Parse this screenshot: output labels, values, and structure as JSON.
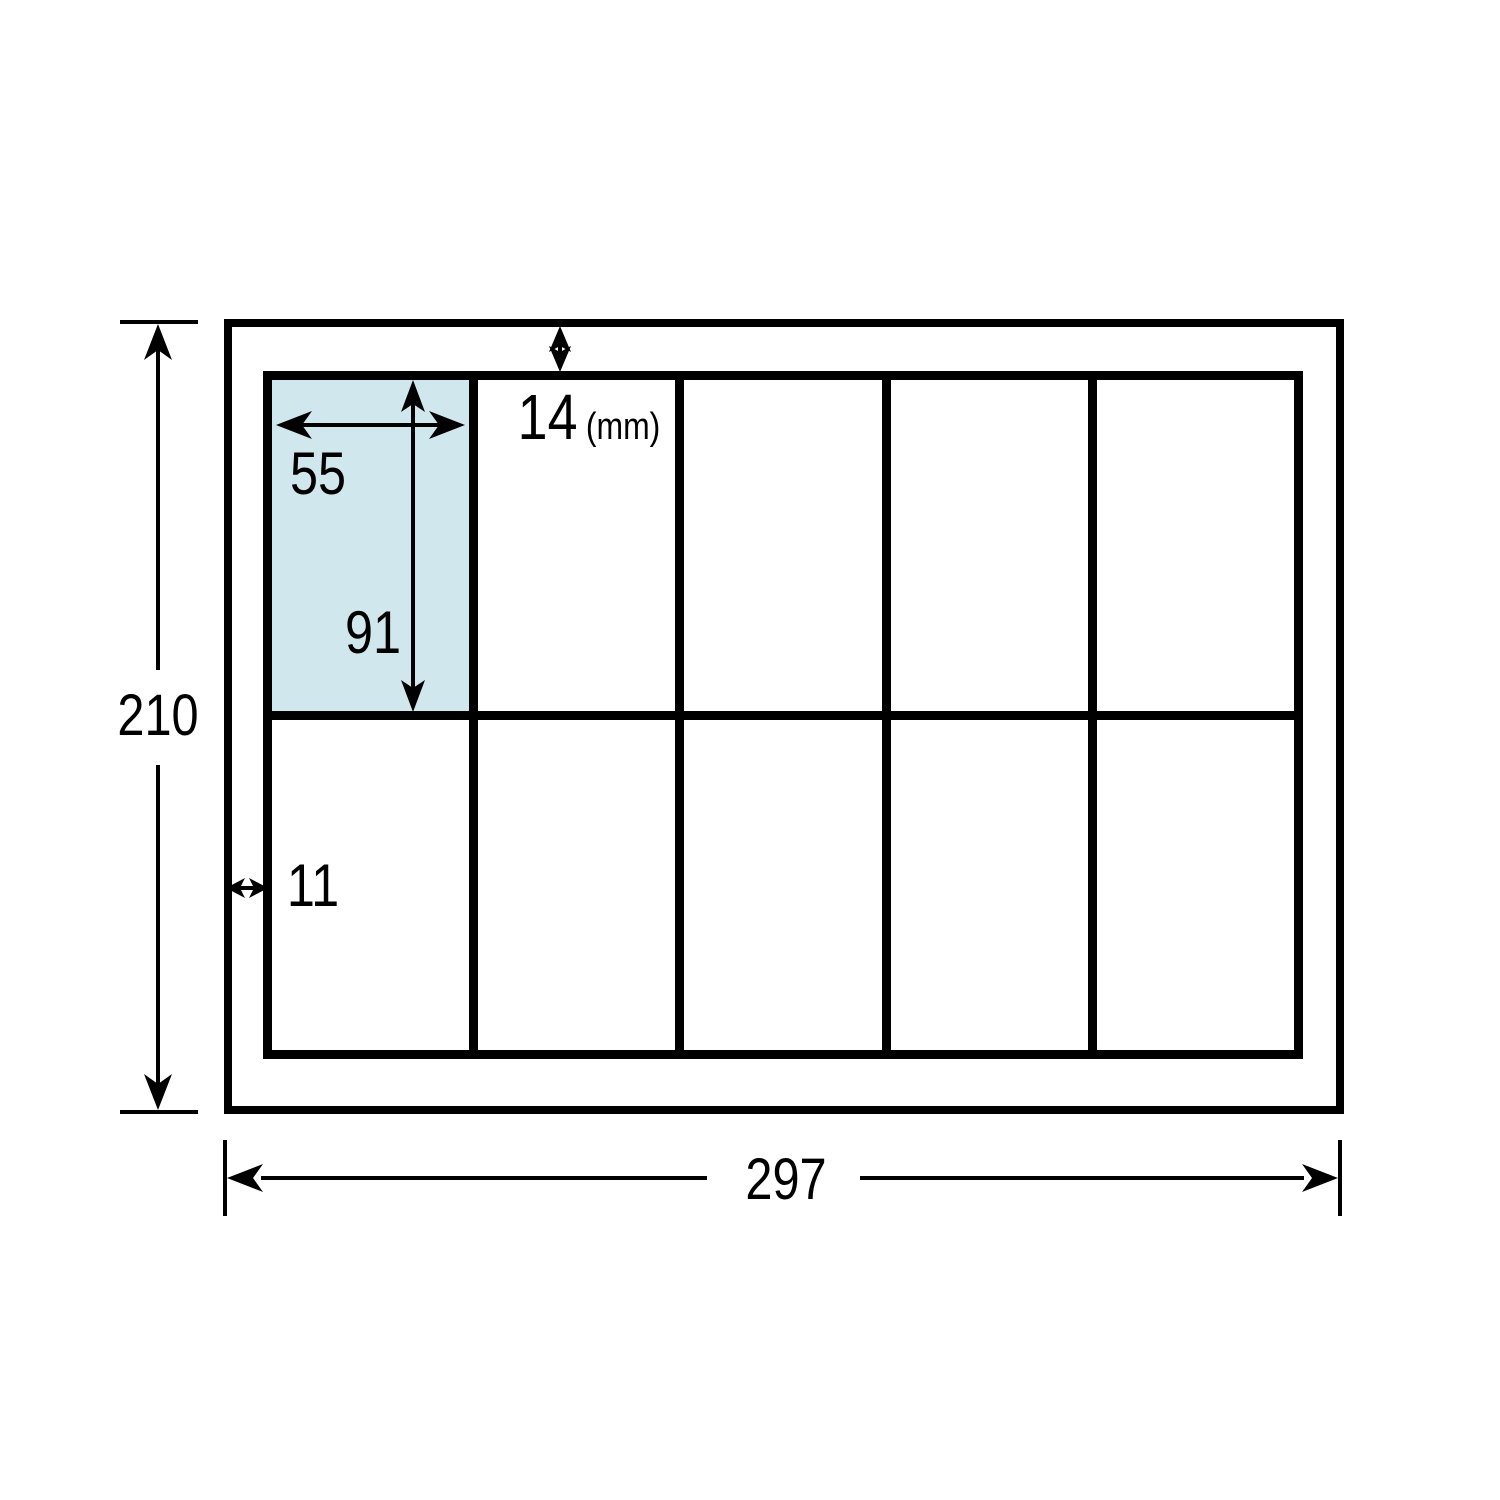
{
  "diagram": {
    "labels": {
      "sheet_height": "210",
      "sheet_width": "297",
      "top_margin": "14",
      "unit": "(mm)",
      "label_width": "55",
      "label_height": "91",
      "left_margin": "11"
    },
    "grid": {
      "columns": 5,
      "rows": 2,
      "highlighted_cell_index": 0
    },
    "colors": {
      "highlight": "#d1e7ee",
      "line": "#000000"
    }
  }
}
